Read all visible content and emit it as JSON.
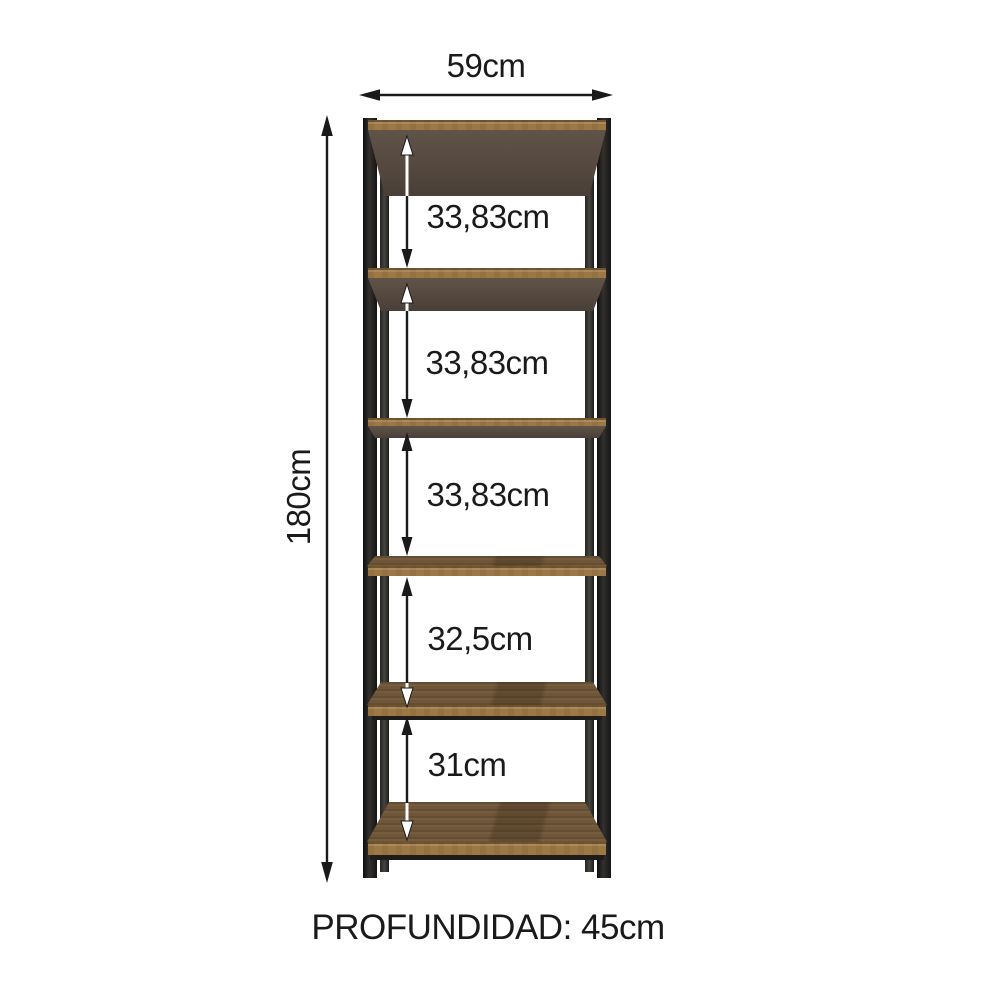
{
  "diagram": {
    "kind": "furniture-dimension-diagram",
    "subject": "5-shelf industrial bookcase with metal frame and wood shelves"
  },
  "dimensions": {
    "width_label": "59cm",
    "height_label": "180cm",
    "depth_label": "PROFUNDIDAD: 45cm",
    "gaps": [
      {
        "label": "33,83cm"
      },
      {
        "label": "33,83cm"
      },
      {
        "label": "33,83cm"
      },
      {
        "label": "32,5cm"
      },
      {
        "label": "31cm"
      }
    ]
  },
  "colors": {
    "frame": "#1d1c1a",
    "frame_rear": "#353330",
    "wood_edge": "#9c7845",
    "wood_top": "#6f5638",
    "underside": "#574a40",
    "arrow": "#1a1a1a",
    "bg": "#ffffff",
    "text": "#1a1a1a"
  }
}
